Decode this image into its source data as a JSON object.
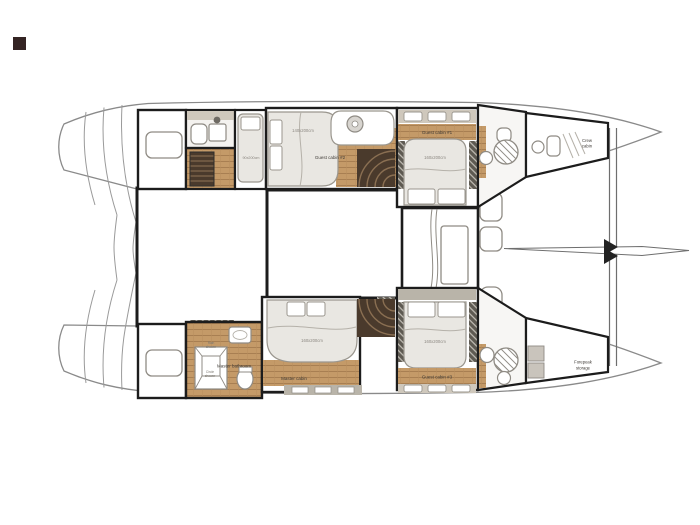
{
  "plan": {
    "guest_cabin_1": {
      "label": "Guest cabin #1",
      "bed": "160x200cm"
    },
    "guest_cabin_2": {
      "label": "Guest cabin #2",
      "bed": "140x200cm"
    },
    "guest_cabin_3": {
      "label": "Guest cabin #3",
      "bed": "160x200cm"
    },
    "master_cabin": {
      "label": "Master cabin",
      "bed": "160x200cm"
    },
    "master_bathroom": {
      "label": "Master bathroom"
    },
    "crew_berth": {
      "bed": "90x200cm"
    },
    "crew_cabin": {
      "line1": "Crew",
      "line2": "cabin"
    },
    "forepeak": {
      "line1": "Forepeak",
      "line2": "storage"
    },
    "rain_shower": {
      "line1": "Rain",
      "line2": "shower"
    },
    "circle_shower": {
      "line1": "Circle",
      "line2": "shower"
    },
    "colors": {
      "wood": "#c49a68",
      "wood_seam": "#a87f52",
      "wall": "#1c1c1c",
      "hull_outline": "#8a8a8a",
      "furniture": "#e9e7e2",
      "deck_beige": "#cfc8bc",
      "storage_gray": "#b9b4a9",
      "stair_dark": "#4a3a2c"
    }
  }
}
